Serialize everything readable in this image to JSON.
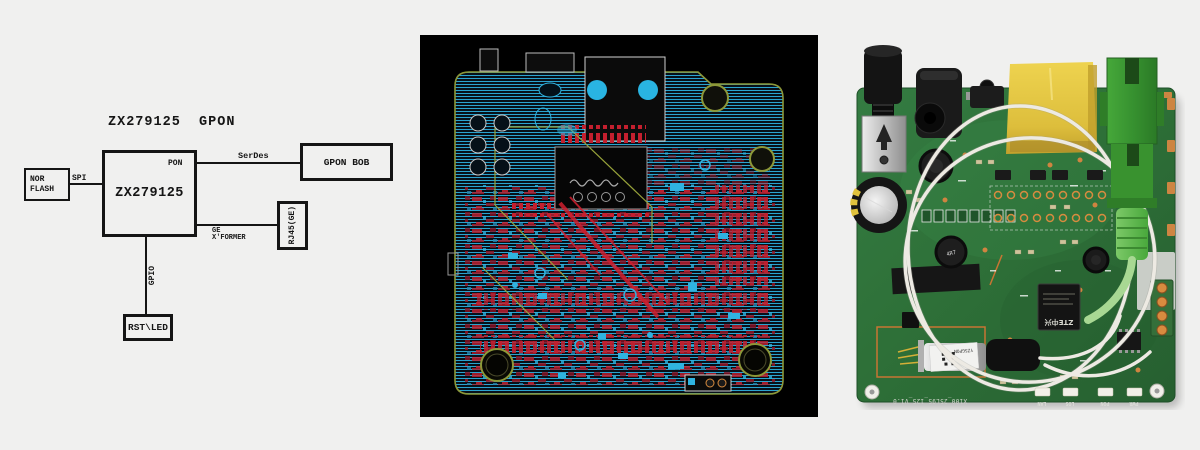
{
  "diagram": {
    "title": "ZX279125  GPON",
    "soc_label": "ZX279125",
    "pon_label": "PON",
    "nor_flash_line1": "NOR",
    "nor_flash_line2": "FLASH",
    "spi_label": "SPI",
    "serdes_label": "SerDes",
    "gpon_bob_label": "GPON BOB",
    "rj45_label": "RJ45(GE)",
    "ge_label_line1": "GE",
    "ge_label_line2": "X'FORMER",
    "gpio_label": "GPIO",
    "rst_led_label": "RST\\LED"
  },
  "photo": {
    "chip_logo": "ZTE中兴",
    "inductor_label": "4R7",
    "bosa_label": "YZ5GPON",
    "board_code": "X100_25L95_125_V1.0",
    "led_labels": [
      "LAN",
      "LOS",
      "PON",
      "PWR"
    ]
  },
  "colors": {
    "background": "#f0f0ef",
    "diagram_ink": "#151515",
    "layout_bg": "#000000",
    "hatch_cyan": "#2aa3cf",
    "trace_red": "#c41f2e",
    "outline_olive": "#8d9838",
    "board_green": "#2f7a40",
    "rj45_yellow": "#e2c83e",
    "sc_green": "#3d9a33",
    "fiber_white": "#edeae3"
  }
}
